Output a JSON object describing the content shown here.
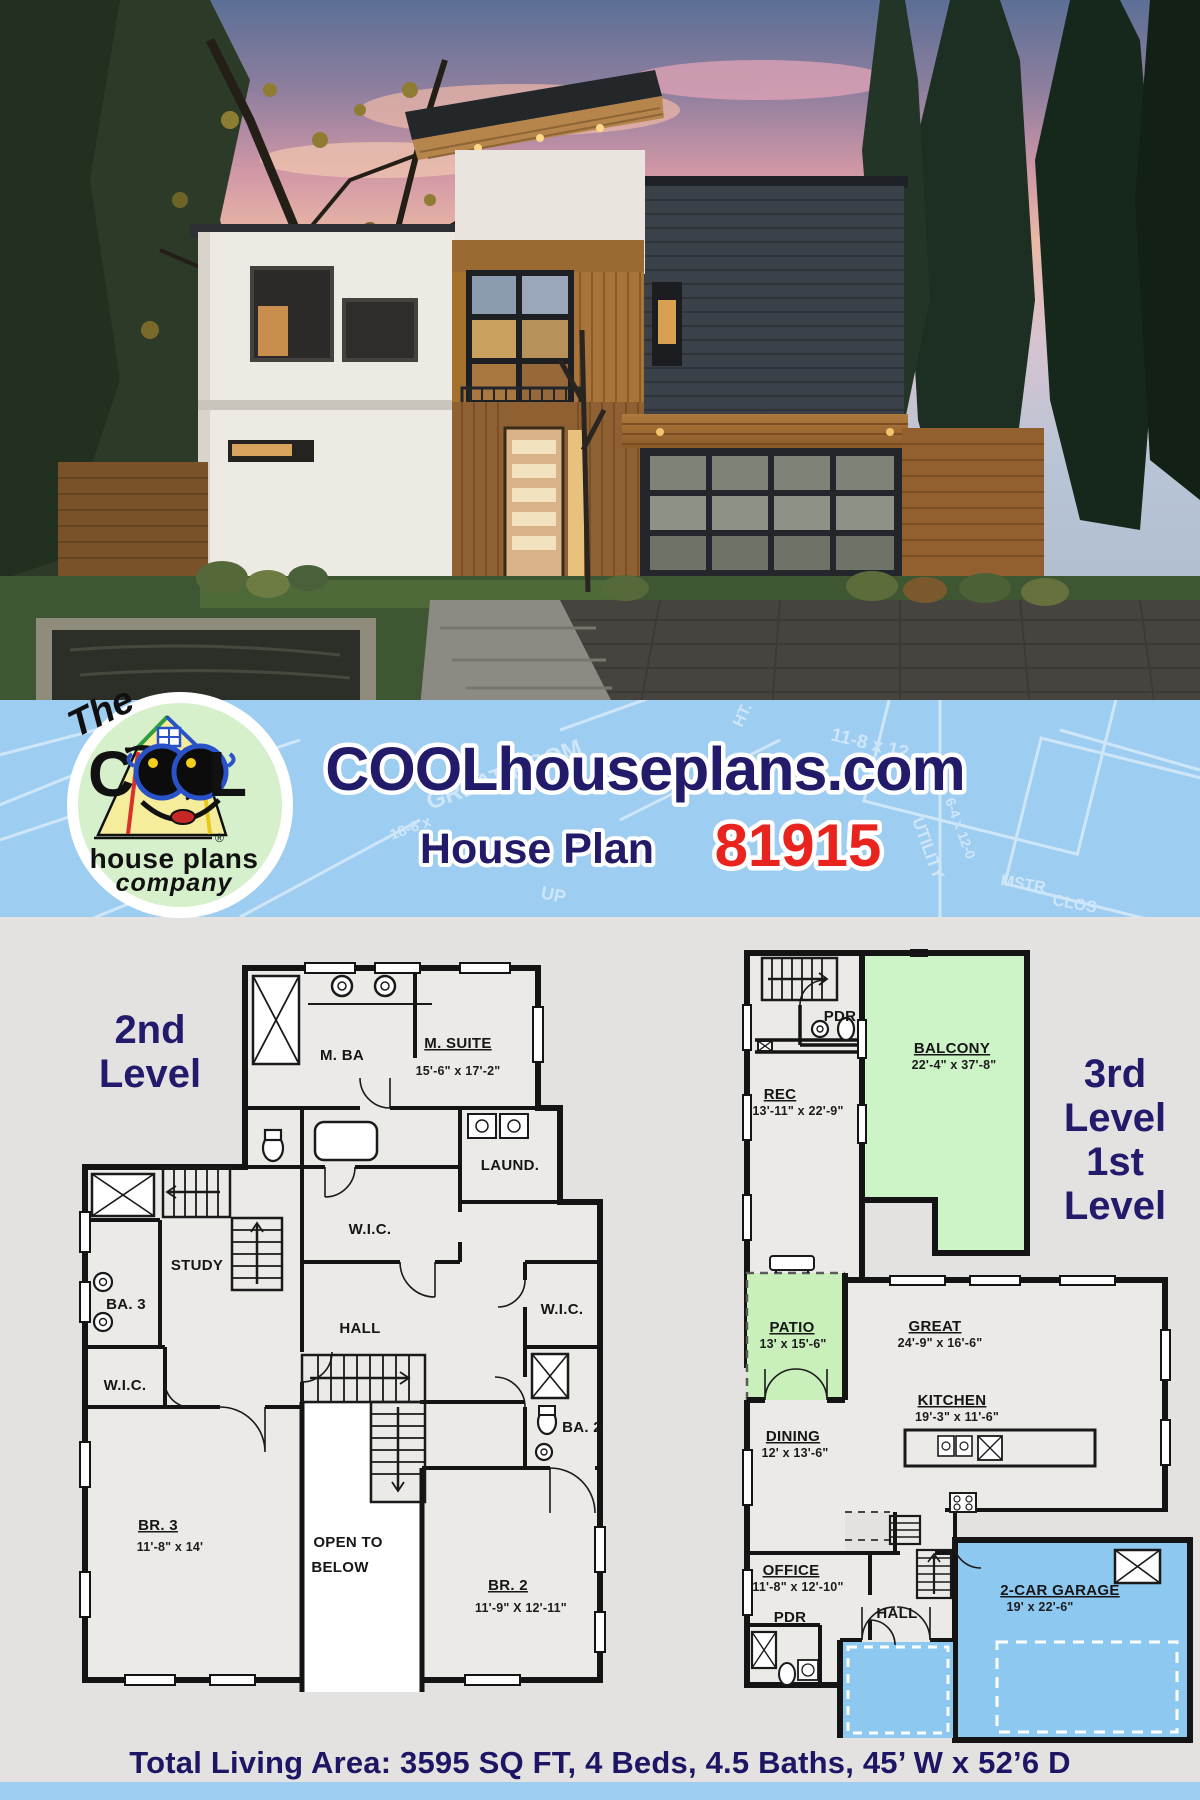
{
  "banner": {
    "site_title": "COOLhouseplans.com",
    "subtitle": "House Plan",
    "plan_number": "81915",
    "sketch_labels": [
      "GREAT ROOM",
      "18-6 x",
      "11-8 x 12",
      "UTILITY",
      "6-4 x 12-0",
      "MSTR",
      "CLOS",
      "UP",
      "HT."
    ]
  },
  "logo": {
    "the": "The",
    "c": "C",
    "l": "L",
    "house_plans": "house plans",
    "company": "company",
    "registered": "®"
  },
  "plans": {
    "second": {
      "title_line1": "2nd",
      "title_line2": "Level",
      "rooms": {
        "mba": {
          "name": "M. BA"
        },
        "msuite": {
          "name": "M. SUITE",
          "dim": "15'-6\" x 17'-2\""
        },
        "wic_master": {
          "name": "W.I.C."
        },
        "laundry": {
          "name": "LAUND."
        },
        "study": {
          "name": "STUDY"
        },
        "ba3": {
          "name": "BA. 3"
        },
        "hall": {
          "name": "HALL"
        },
        "wic_br2": {
          "name": "W.I.C."
        },
        "wic_br3": {
          "name": "W.I.C."
        },
        "ba2": {
          "name": "BA. 2"
        },
        "open_below": {
          "line1": "OPEN TO",
          "line2": "BELOW"
        },
        "br3": {
          "name": "BR. 3",
          "dim": "11'-8\" x 14'"
        },
        "br2": {
          "name": "BR. 2",
          "dim": "11'-9\" X 12'-11\""
        }
      }
    },
    "third": {
      "title_line1": "3rd",
      "title_line2": "Level",
      "rooms": {
        "rec": {
          "name": "REC",
          "dim": "13'-11\" x 22'-9\""
        },
        "pdr": {
          "name": "PDR"
        },
        "balcony": {
          "name": "BALCONY",
          "dim": "22'-4\" x 37'-8\""
        }
      }
    },
    "first": {
      "title_line1": "1st",
      "title_line2": "Level",
      "rooms": {
        "patio": {
          "name": "PATIO",
          "dim": "13' x 15'-6\""
        },
        "great": {
          "name": "GREAT",
          "dim": "24'-9\" x 16'-6\""
        },
        "kitchen": {
          "name": "KITCHEN",
          "dim": "19'-3\" x 11'-6\""
        },
        "dining": {
          "name": "DINING",
          "dim": "12' x 13'-6\""
        },
        "office": {
          "name": "OFFICE",
          "dim": "11'-8\" x 12'-10\""
        },
        "hall": {
          "name": "HALL"
        },
        "pdr": {
          "name": "PDR"
        },
        "garage": {
          "name": "2-CAR GARAGE",
          "dim": "19' x 22'-6\""
        }
      }
    }
  },
  "footer": {
    "summary": "Total Living Area: 3595 SQ FT, 4 Beds, 4.5 Baths, 45’ W x 52’6 D"
  },
  "colors": {
    "banner_blue": "#9ecdf2",
    "navy": "#221b6a",
    "red": "#e9241f",
    "page_gray": "#e4e2e0",
    "balcony_green": "#cdf4c6",
    "patio_green": "#c9f0bb",
    "garage_blue": "#8dc8f1",
    "plan_fill": "#ebeae7",
    "wall": "#141414"
  }
}
